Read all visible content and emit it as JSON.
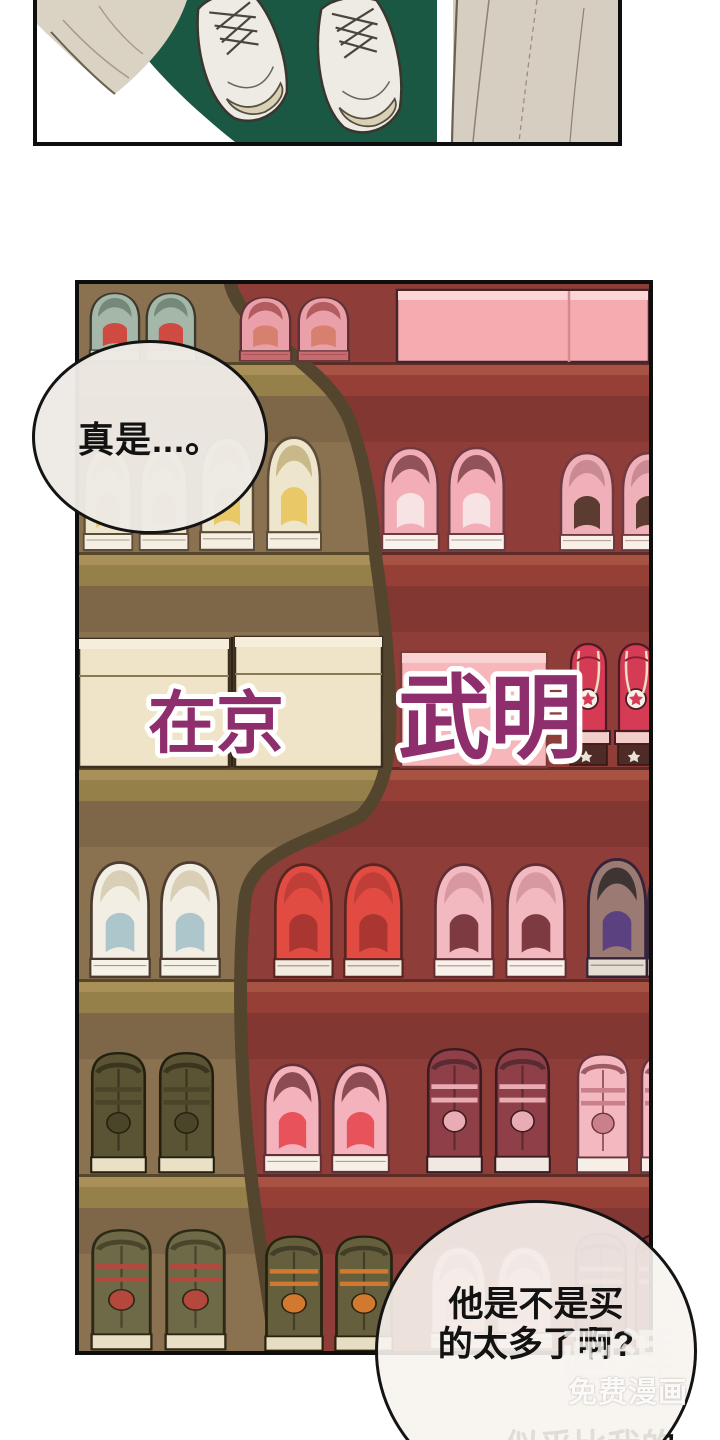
{
  "page_type": "webtoon-comic-page",
  "bubbles": {
    "top": {
      "text": "真是...。"
    },
    "bottom": {
      "line1": "他是不是买",
      "line2": "的太多了啊?"
    }
  },
  "overlay_title": {
    "part1": "在京",
    "part2": "武明",
    "color": "#8e2e6d",
    "outline": "#ffffff"
  },
  "watermark": {
    "logo": "画涯",
    "tagline": "免费漫画"
  },
  "caption_bottom": {
    "text": "似乎比我的"
  },
  "palette": {
    "panel_border": "#0e0e0e",
    "panel1_garment_green": "#1b5843",
    "panel1_fabric_beige": "#dad2c3",
    "rack_wall_red": "#8e3d38",
    "rack_wall_lit_brown": "#8a7150",
    "rack_shadow_edge": "#54462e",
    "shelf_board_red": "#a85244",
    "shelf_board_olive": "#a89058",
    "shoebox_cream": "#efe4c8",
    "shoebox_pink": "#f7b6b9",
    "speech_bubble_fill": "#f1ede7"
  }
}
